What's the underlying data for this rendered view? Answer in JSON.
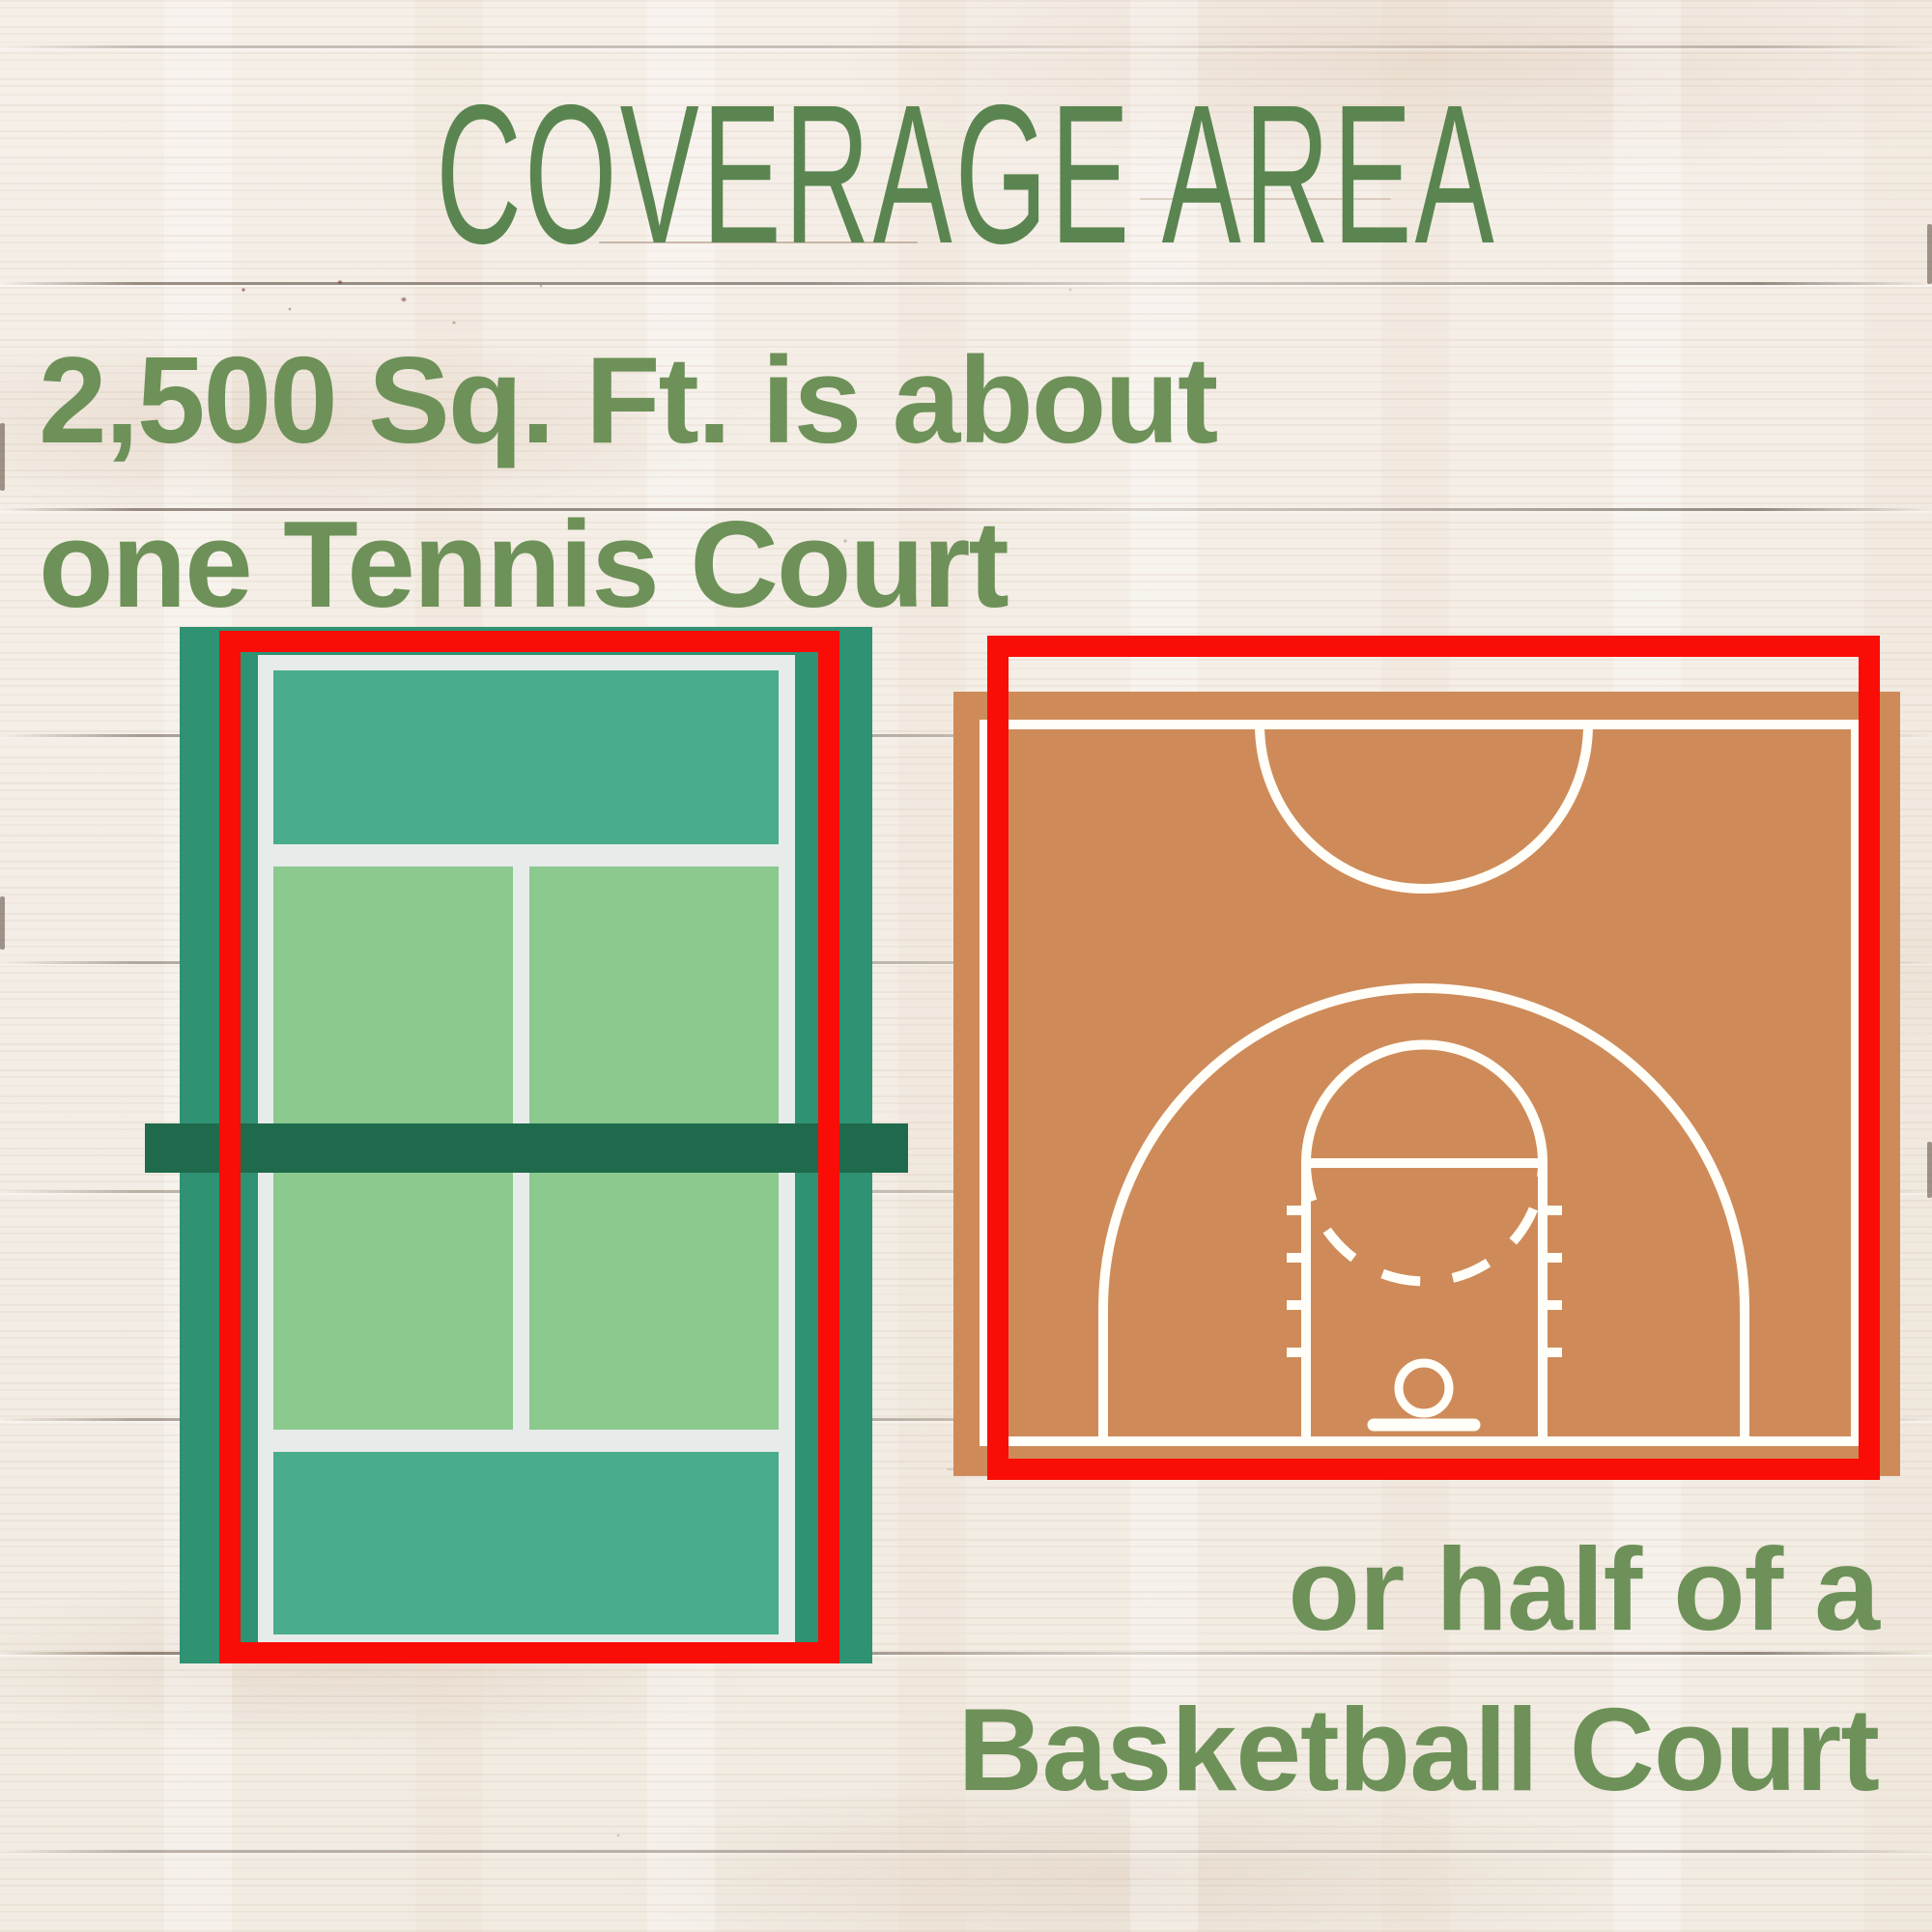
{
  "header": {
    "title": "COVERAGE AREA"
  },
  "subtitle": {
    "line1": "2,500 Sq. Ft. is about",
    "line2": "one Tennis Court"
  },
  "caption": {
    "line1": "or half of a",
    "line2": "Basketball Court"
  },
  "figures": {
    "tennis": {
      "name": "tennis-court",
      "outline": "coverage-area-square"
    },
    "basketball": {
      "name": "basketball-half-court",
      "outline": "coverage-area-square"
    }
  },
  "colors": {
    "title-green": "#5a8550",
    "text-green": "#6d9158",
    "outline-red": "#f90d06",
    "tennis-border-teal": "#2e9273",
    "tennis-backcourt-teal": "#48ac8d",
    "tennis-service-green": "#8bc98e",
    "tennis-line-white": "#e7ebea",
    "tennis-net-green": "#1f6a4c",
    "basketball-orange": "#ce8b59",
    "basketball-line-white": "#fffef8",
    "wood-base": "#f5efe8"
  }
}
